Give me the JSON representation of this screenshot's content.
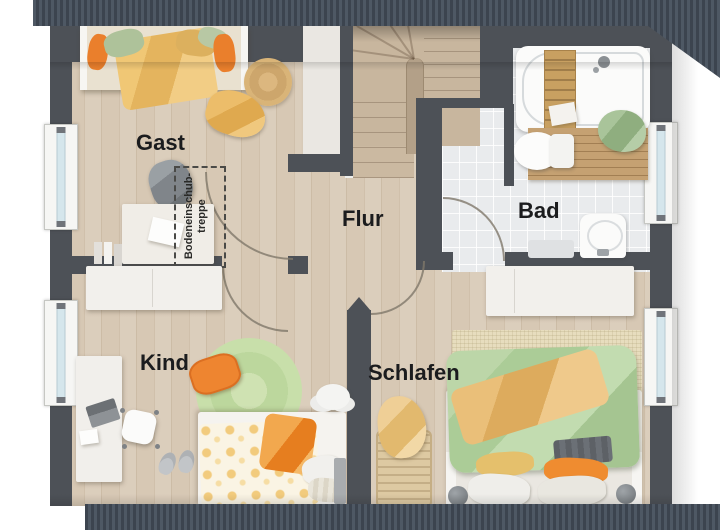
{
  "type": "floor-plan-upper-storey",
  "rooms": [
    {
      "id": "gast",
      "label": "Gast"
    },
    {
      "id": "flur",
      "label": "Flur"
    },
    {
      "id": "bad",
      "label": "Bad"
    },
    {
      "id": "kind",
      "label": "Kind"
    },
    {
      "id": "schlafen",
      "label": "Schlafen"
    }
  ],
  "attic": {
    "line1": "Bodeneinschub-",
    "line2": "treppe"
  },
  "colors": {
    "roof_band": "#454e59",
    "wall": "#4d5157",
    "interior_wall_light": "#eae7e2",
    "wood_floor": "#d7c8b4",
    "tile_floor": "#e9ebed",
    "stairs_wood": "#c8b69e",
    "accent_orange": "#ed8230",
    "accent_sage": "#b7d3a3",
    "accent_yellow": "#ecc06c",
    "window_glass": "#d5e6ec"
  },
  "furniture": {
    "gast": [
      "single-bed",
      "round-jute-rug",
      "throw-blanket",
      "travel-bag",
      "side-table",
      "attic-hatch-outline"
    ],
    "flur": [
      "winder-staircase"
    ],
    "bad": [
      "bathtub",
      "shower",
      "toilet",
      "sink",
      "wood-bath-mat",
      "towel"
    ],
    "kind": [
      "wardrobe",
      "desk",
      "office-chair",
      "slippers",
      "round-rug",
      "single-bed",
      "cushion"
    ],
    "schlafen": [
      "wardrobe",
      "double-bed",
      "sisal-rug",
      "laundry-basket"
    ]
  }
}
